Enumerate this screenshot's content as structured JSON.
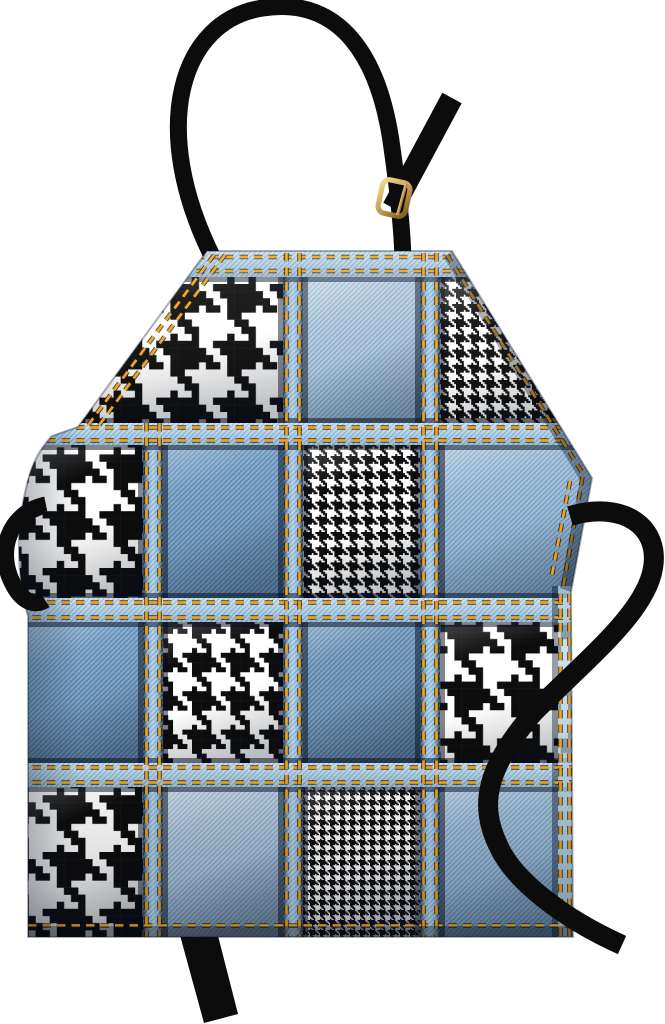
{
  "image": {
    "width": 665,
    "height": 1024,
    "background": "#ffffff",
    "subject": "denim patchwork apron with black and white houndstooth patches"
  },
  "palette": {
    "strap": "#0c0c0c",
    "buckle": [
      "#f0db92",
      "#c19a4a",
      "#7a5c22"
    ],
    "stitch": "#e8a426",
    "stitch_shadow": "rgba(40,24,4,0.8)",
    "houndstooth": {
      "black": "#0d0d0d",
      "white": "#ffffff"
    },
    "denim": {
      "light": [
        "#bdd3e6",
        "#8cafcd"
      ],
      "medium": [
        "#7fa9cf",
        "#5d87ae"
      ],
      "medium_light": [
        "#a6c5df",
        "#7aa3c7"
      ],
      "dark": [
        "#7aa1c5",
        "#587fa2"
      ],
      "sash": [
        "#c8e1f2",
        "#8fb6d6"
      ],
      "v_strip": [
        "#22384d",
        "#8fb4d4",
        "#aed2ea",
        "#22384d"
      ],
      "hem": "#b5d2e8"
    }
  },
  "grid": {
    "columns": [
      [
        26,
        143
      ],
      [
        163,
        283
      ],
      [
        303,
        420
      ],
      [
        440,
        578
      ]
    ],
    "rows": [
      [
        277,
        423
      ],
      [
        445,
        598
      ],
      [
        622,
        763
      ],
      [
        787,
        937
      ]
    ],
    "v_strips": [
      {
        "x": [
          143,
          163
        ],
        "y": [
          423,
          937
        ]
      },
      {
        "x": [
          283,
          303
        ],
        "y": [
          251,
          937
        ]
      },
      {
        "x": [
          420,
          440
        ],
        "y": [
          251,
          937
        ]
      }
    ],
    "h_strips": [
      {
        "y": [
          251,
          277
        ]
      },
      {
        "y": [
          423,
          445
        ]
      },
      {
        "y": [
          598,
          622
        ]
      },
      {
        "y": [
          763,
          787
        ]
      }
    ],
    "cells": [
      [
        "houndstooth-large",
        "houndstooth-large",
        "denim-light",
        "houndstooth-fine"
      ],
      [
        "houndstooth-large",
        "denim-medium",
        "houndstooth-fine",
        "denim-medium-light"
      ],
      [
        "denim-medium",
        "houndstooth-medium",
        "denim-dark",
        "houndstooth-large"
      ],
      [
        "houndstooth-large",
        "denim-light",
        "houndstooth-extra-fine",
        "denim-medium-light"
      ]
    ],
    "houndstooth_thread_px": {
      "large": 7.1,
      "medium": 4.8,
      "fine": 1.9,
      "extra_fine": 1.25
    }
  },
  "parts": {
    "neck_strap": "adjustable black neck strap",
    "buckle": "gold slide buckle",
    "left_waist_tie": "black tie loop at left waist",
    "right_waist_tie": "black tie looping over lower right",
    "bottom_tie": "black tie hanging below hem"
  }
}
